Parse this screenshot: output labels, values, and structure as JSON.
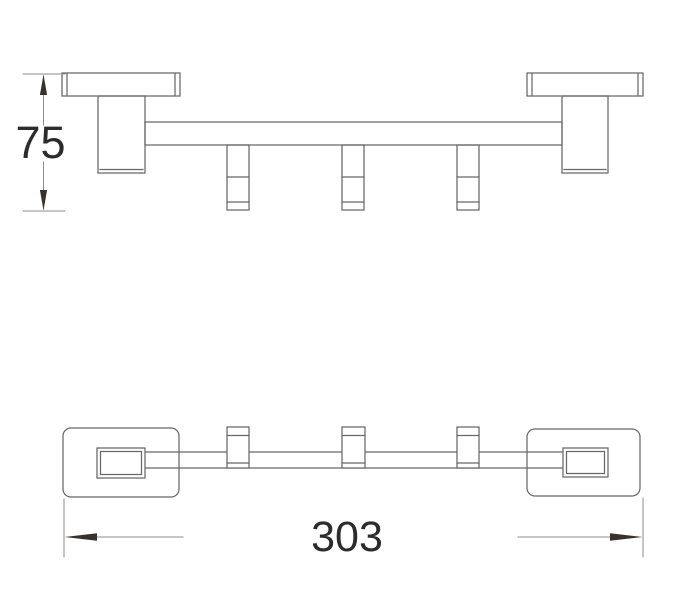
{
  "drawing": {
    "kind": "technical-dimension-diagram",
    "hook_count": 3,
    "views": [
      "side-elevation",
      "plan"
    ],
    "dimensions": {
      "height": {
        "value": "75"
      },
      "width": {
        "value": "303"
      }
    },
    "colors": {
      "background": "#ffffff",
      "outline": "#686868",
      "dimension_line": "#8e8e8e",
      "arrow": "#39322c",
      "text": "#2c2c2c"
    }
  }
}
